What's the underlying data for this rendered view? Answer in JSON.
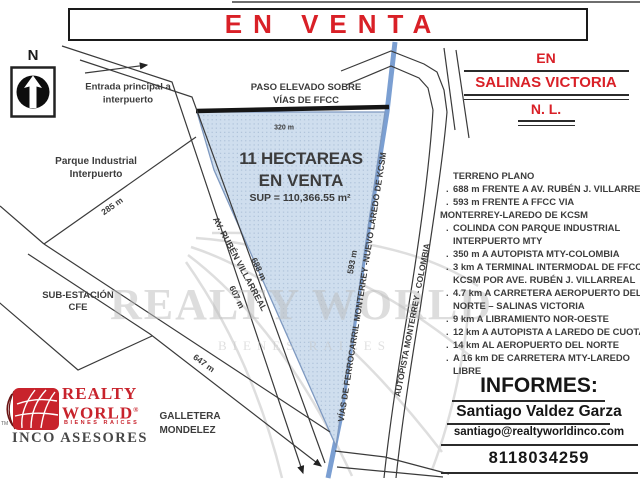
{
  "banner": {
    "text": "EN VENTA"
  },
  "location_header": {
    "line1": "EN",
    "line2": "SALINAS VICTORIA",
    "line3": "N. L."
  },
  "compass": {
    "label": "N"
  },
  "map": {
    "entrada": "Entrada principal a\ninterpuerto",
    "paso_elevado": "PASO ELEVADO SOBRE\nVÍAS DE FFCC",
    "parque": "Parque Industrial\nInterpuerto",
    "subestacion": "SUB-ESTACIÓN\nCFE",
    "galletera": "GALLETERA\nMONDELEZ",
    "av_ruben": "AV. RUBÉN VILLARREAL",
    "vias_ffcc": "VÍAS DE FERROCARRIL MONTERREY -NUEVO LAREDO DE KCSM",
    "autopista": "AUTOPISTA MONTERREY - COLOMBIA",
    "property": {
      "line1": "11 HECTAREAS",
      "line2": "EN VENTA",
      "surface": "SUP = 110,366.55 m²"
    },
    "dims": {
      "d320": "320 m",
      "d285": "285 m",
      "d607": "607 m",
      "d647": "647 m",
      "d688": "688 m",
      "d593": "593 m"
    }
  },
  "details": {
    "items": [
      {
        "bullet": "",
        "indent": 13,
        "text": "TERRENO PLANO"
      },
      {
        "bullet": ".",
        "indent": 13,
        "text": "688 m FRENTE A AV. RUBÉN J. VILLARREAL"
      },
      {
        "bullet": ".",
        "indent": 13,
        "text": "593 m FRENTE A FFCC VIA"
      },
      {
        "bullet": "",
        "indent": 0,
        "text": "MONTERREY-LAREDO DE KCSM"
      },
      {
        "bullet": ".",
        "indent": 13,
        "text": "COLINDA CON PARQUE INDUSTRIAL"
      },
      {
        "bullet": "",
        "indent": 13,
        "text": "INTERPUERTO MTY"
      },
      {
        "bullet": ".",
        "indent": 13,
        "text": "350 m A AUTOPISTA MTY-COLOMBIA"
      },
      {
        "bullet": ".",
        "indent": 13,
        "text": "3 km A TERMINAL INTERMODAL DE FFCC"
      },
      {
        "bullet": "",
        "indent": 13,
        "text": "KCSM POR AVE. RUBÉN J. VILLARREAL"
      },
      {
        "bullet": ".",
        "indent": 13,
        "text": "4.7 km A CARRETERA AEROPUERTO DEL"
      },
      {
        "bullet": "",
        "indent": 13,
        "text": "NORTE – SALINAS VICTORIA"
      },
      {
        "bullet": ".",
        "indent": 13,
        "text": "9 km A LIBRAMIENTO NOR-OESTE"
      },
      {
        "bullet": ".",
        "indent": 13,
        "text": "12 km A AUTOPISTA A LAREDO DE CUOTA"
      },
      {
        "bullet": ".",
        "indent": 13,
        "text": "14 km AL AEROPUERTO DEL NORTE"
      },
      {
        "bullet": ".",
        "indent": 13,
        "text": "A 16 km DE CARRETERA MTY-LAREDO"
      },
      {
        "bullet": "",
        "indent": 13,
        "text": "LIBRE"
      }
    ]
  },
  "informes": {
    "heading": "INFORMES:",
    "contact_name": "Santiago Valdez Garza",
    "email": "santiago@realtyworldinco.com",
    "phone": "8118034259"
  },
  "logo": {
    "tm": "TM",
    "realty": "REALTY",
    "world": "WORLD",
    "registered": "®",
    "tagline": "BIENES RAICES",
    "company": "INCO ASESORES"
  },
  "watermark": {
    "main": "REALTY WORLD",
    "sub": "BIENES RAICES"
  },
  "colors": {
    "accent_red": "#d92027",
    "railway_blue": "#7b9fd2",
    "parcel_fill": "#cfdeee",
    "parcel_dot": "#a6bbd4",
    "logo_red": "#c8232c",
    "line_dark": "#3a3a3a"
  }
}
